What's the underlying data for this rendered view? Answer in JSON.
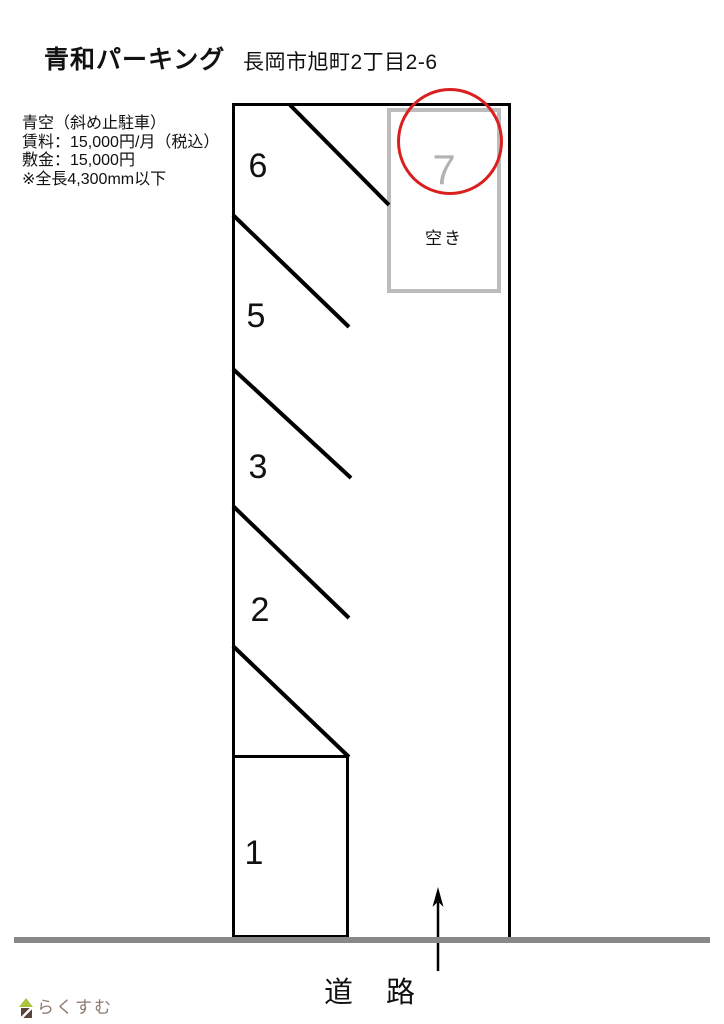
{
  "header": {
    "title": "青和パーキング",
    "address": "長岡市旭町2丁目2-6"
  },
  "info": {
    "lines": [
      "青空（斜め止駐車）",
      "賃料：15,000円/月（税込）",
      "敷金：15,000円",
      "※全長4,300mm以下"
    ]
  },
  "lot": {
    "spaces": [
      {
        "number": "6"
      },
      {
        "number": "5"
      },
      {
        "number": "3"
      },
      {
        "number": "2"
      },
      {
        "number": "1"
      },
      {
        "number": "7",
        "status": "vacant"
      }
    ],
    "vacant_label": "空き"
  },
  "road": {
    "label": "道　路"
  },
  "logo": {
    "text": "らくすむ"
  },
  "colors": {
    "line": "#000000",
    "vacant_border": "#bcbcbc",
    "vacant_number": "#b3b3b3",
    "highlight_circle": "#da1f1f",
    "road": "#888888",
    "logo_text": "#8d7b6f",
    "logo_roof": "#a9c23f",
    "logo_base": "#57453d"
  }
}
